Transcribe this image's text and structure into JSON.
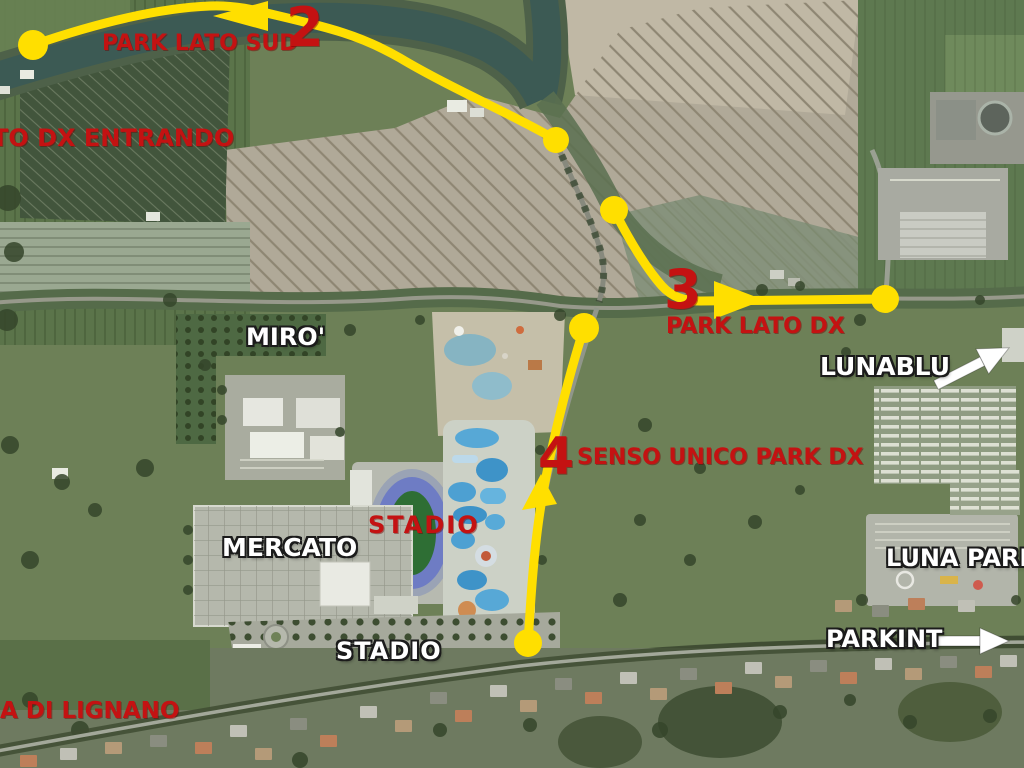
{
  "colors": {
    "route_yellow": "#ffdf00",
    "label_red": "#c41212",
    "label_white": "#ffffff",
    "arrow_white": "#ffffff"
  },
  "labels": {
    "park_lato_sud": {
      "text": "PARK LATO SUD"
    },
    "route2_number": {
      "text": "2"
    },
    "lato_dx_entrando": {
      "text": "TO DX ENTRANDO"
    },
    "route3_number": {
      "text": "3"
    },
    "park_lato_dx": {
      "text": "PARK LATO DX"
    },
    "route4_number": {
      "text": "4"
    },
    "senso_unico": {
      "text": "SENSO UNICO PARK DX"
    },
    "stadio_area": {
      "text": "STADIO"
    },
    "miro": {
      "text": "MIRO'"
    },
    "mercato": {
      "text": "MERCATO"
    },
    "stadio_parking": {
      "text": "STADIO"
    },
    "lunablu": {
      "text": "LUNABLU"
    },
    "luna_park": {
      "text": "LUNA PARK"
    },
    "parkint": {
      "text": "PARKINT"
    },
    "lignano": {
      "text": "A DI LIGNANO"
    }
  },
  "routes": [
    {
      "number": "2",
      "caption": "PARK LATO SUD",
      "arrow_direction": "left",
      "waypoints": 2
    },
    {
      "number": "3",
      "caption": "PARK LATO DX",
      "arrow_direction": "right",
      "waypoints": 2
    },
    {
      "number": "4",
      "caption": "SENSO UNICO PARK DX",
      "arrow_direction": "up",
      "waypoints": 2
    }
  ],
  "pointers": [
    {
      "target": "LUNABLU",
      "direction": "up-right"
    },
    {
      "target": "PARKINT",
      "direction": "right"
    }
  ]
}
